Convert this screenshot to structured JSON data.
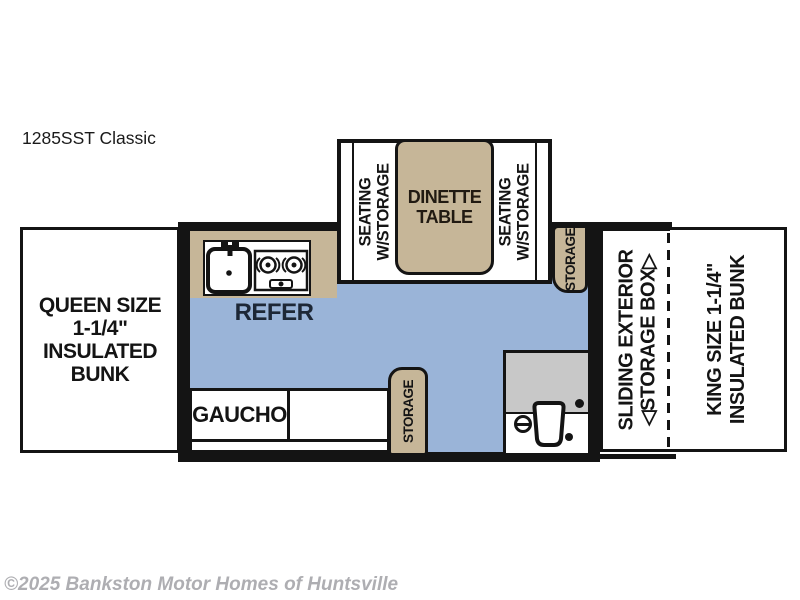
{
  "page": {
    "title": "1285SST Classic",
    "copyright": "©2025 Bankston Motor Homes of Huntsville"
  },
  "colors": {
    "floor_blue": "#9ab4d8",
    "furniture_tan": "#c6b698",
    "shower_gray": "#c8c8c8",
    "wall_black": "#141414",
    "refer_text_navy": "#1d2736",
    "copyright_gray": "#aeaeb2"
  },
  "floorplan": {
    "queen_bunk": {
      "lines": [
        "QUEEN SIZE",
        "1-1/4\"",
        "INSULATED",
        "BUNK"
      ]
    },
    "kitchen": {
      "refer_label": "REFER"
    },
    "dinette": {
      "seating_lines": [
        "SEATING",
        "W/STORAGE"
      ],
      "table_lines": [
        "DINETTE",
        "TABLE"
      ]
    },
    "storage_label": "STORAGE",
    "gaucho_label": "GAUCHO",
    "sliding_storage": {
      "lines": [
        "SLIDING EXTERIOR",
        "◁STORAGE BOX▷"
      ]
    },
    "king_bunk": {
      "lines": [
        "KING SIZE 1-1/4\"",
        "INSULATED BUNK"
      ]
    }
  }
}
